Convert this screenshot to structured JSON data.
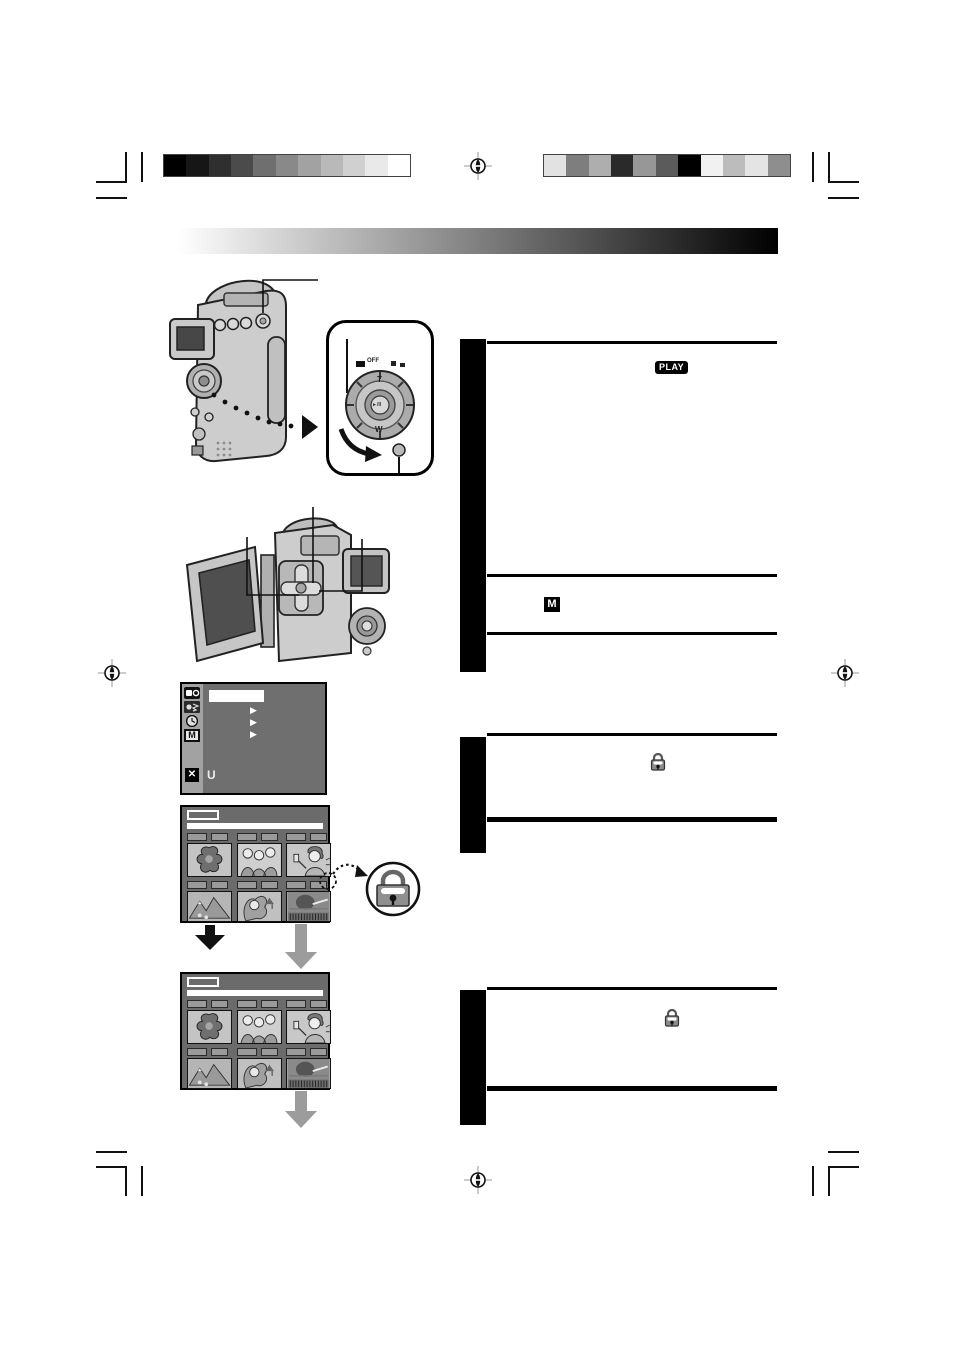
{
  "page": {
    "width": 954,
    "height": 1350,
    "background": "#ffffff"
  },
  "calibration": {
    "left_strip": [
      "#000000",
      "#161616",
      "#2f2f2f",
      "#4b4b4b",
      "#6f6f6f",
      "#898989",
      "#a2a2a2",
      "#b9b9b9",
      "#d0d0d0",
      "#e9e9e9",
      "#ffffff"
    ],
    "right_strip": [
      "#e2e2e2",
      "#7e7e7e",
      "#aeaeae",
      "#2a2a2a",
      "#979797",
      "#5b5b5b",
      "#000000",
      "#f1f1f1",
      "#bcbcbc",
      "#e4e4e4",
      "#8e8e8e"
    ]
  },
  "header_bar": {
    "gradient_from": "#ffffff",
    "gradient_to": "#000000"
  },
  "dial_callout": {
    "off_label": "OFF",
    "tele_label": "T",
    "wide_label": "W",
    "center_button_glyph": "►/II"
  },
  "menu_screen": {
    "memory_icon_label": "M",
    "close_glyph": "✕",
    "return_glyph": "U",
    "submenu_arrow_glyph": "▶"
  },
  "right_column": {
    "play_mode_badge": "PLAY",
    "memory_mode_badge": "M"
  },
  "icons": {
    "protect_lock": "padlock-icon",
    "registration": "registration-mark"
  },
  "colors": {
    "step_sidebar": "#000000",
    "screen_background": "#6b6b6b",
    "gray_arrow": "#9c9c9c"
  }
}
